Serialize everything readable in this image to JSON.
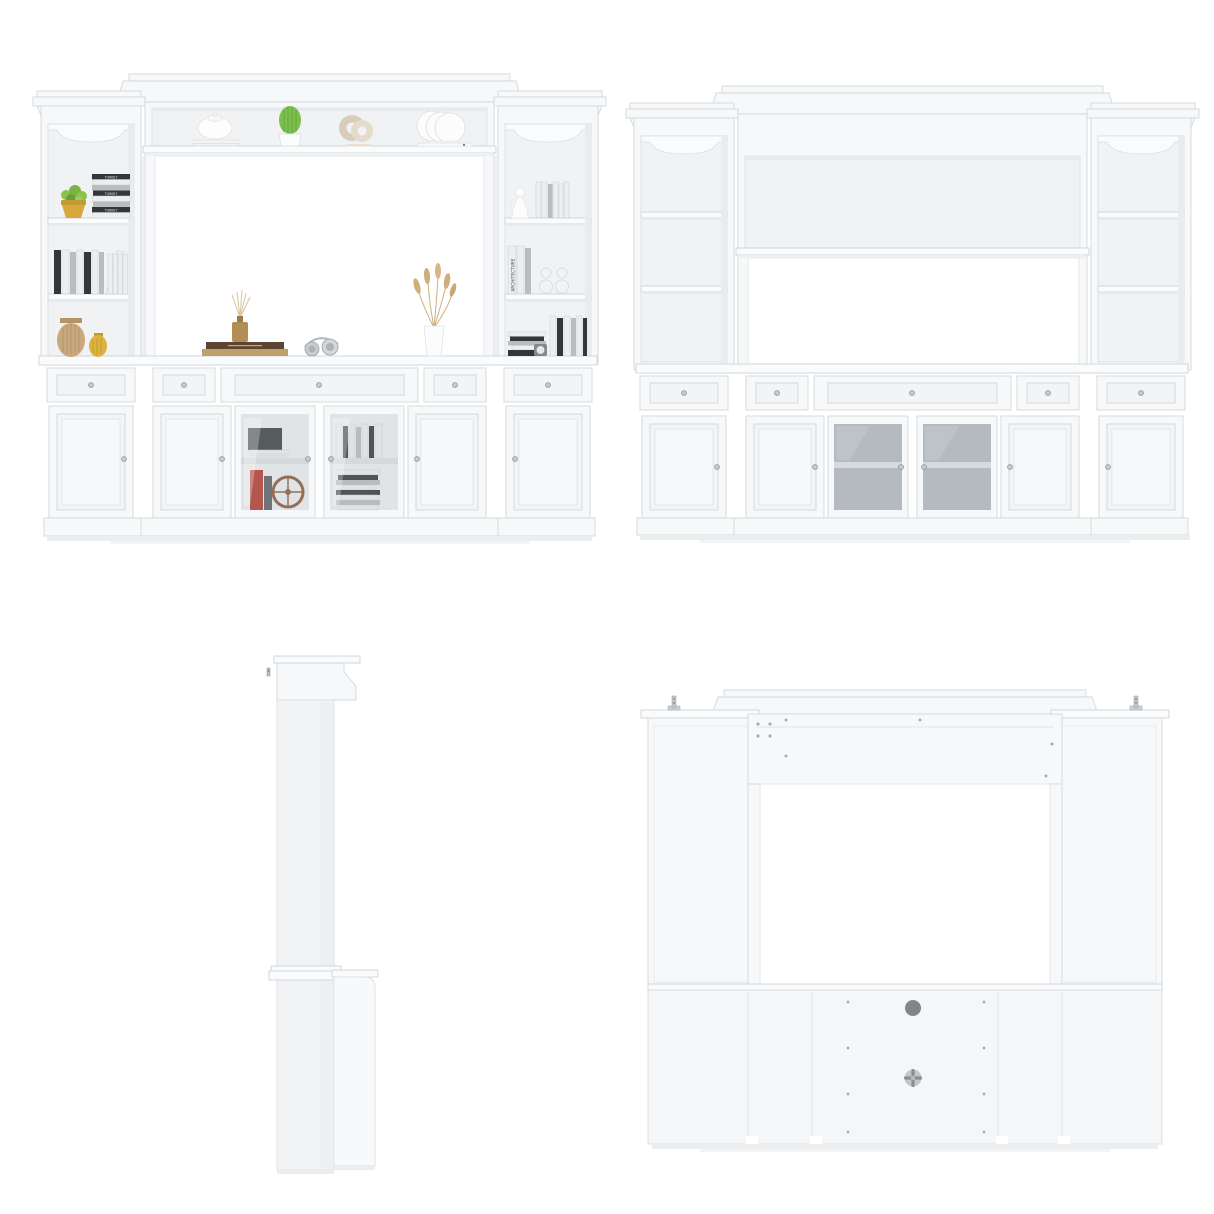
{
  "page": {
    "background": "#ffffff",
    "subject": "white-entertainment-center-wall-unit-product-collage"
  },
  "views": [
    {
      "id": "front-styled",
      "name": "front-view-with-decor"
    },
    {
      "id": "front-plain",
      "name": "front-elevation-empty"
    },
    {
      "id": "side-profile",
      "name": "side-profile-view"
    },
    {
      "id": "back",
      "name": "back-view-with-cable-holes"
    }
  ],
  "texts": {
    "turkey_spine": "TURKEY",
    "architecture_spine": "ARCHITECTURE"
  },
  "palette": {
    "background": "#ffffff",
    "panel_white": "#f7f8f9",
    "panel_bright": "#fbfcfd",
    "panel_interior": "#f0f2f3",
    "panel_shade": "#e8eaec",
    "outline_gray": "#d3d7da",
    "glass_gray": "#b4bac0",
    "glass_shelf": "#d6dadd",
    "knob_silver": "#c7ccd0",
    "knob_ring": "#878e93",
    "cable_hole_gray": "#7f8589",
    "grommet_gray": "#c3c7ca",
    "grommet_cross": "#888e92",
    "bracket_metal": "#c3c8cc",
    "screw_gray": "#aeb4b8",
    "shadow_gray": "#e9ebed",
    "succulent_green": "#8bc34a",
    "cactus_green": "#7cbf4e",
    "cactus_dark": "#5ea43a",
    "gold_pot": "#d7a93c",
    "gold_vase": "#ddb23e",
    "tan_vase": "#c9a87f",
    "tan_vase_rib": "#b08e63",
    "beige_ring": "#d8cdbc",
    "beige_ring_front": "#e4dbcb",
    "brown_book": "#5d4433",
    "tan_book": "#bfa06a",
    "amber_bottle": "#b28e57",
    "reed_tan": "#d9c9a8",
    "pampas_tan": "#cfae7e",
    "red_book": "#b43a2e",
    "dark_item": "#3c4043",
    "wheel_brown": "#8a5a3b",
    "book_dark": "#34373a",
    "book_white": "#eceeef",
    "book_gray": "#b9bdc0"
  },
  "decor_items": [
    {
      "name": "succulent-in-gold-pot",
      "color": "gold_pot"
    },
    {
      "name": "turkey-book-stack",
      "label": "TURKEY"
    },
    {
      "name": "standing-books",
      "color": "book_white"
    },
    {
      "name": "tan-ribbed-vases",
      "color": "tan_vase"
    },
    {
      "name": "white-teapot-on-books",
      "color": "panel_bright"
    },
    {
      "name": "cactus-in-white-pot",
      "color": "cactus_green"
    },
    {
      "name": "ring-sculpture",
      "color": "beige_ring"
    },
    {
      "name": "plate-rack-with-book",
      "color": "panel_bright"
    },
    {
      "name": "book-stack-with-reed-diffuser",
      "color": "amber_bottle"
    },
    {
      "name": "headphones",
      "color": "knob_silver"
    },
    {
      "name": "pampas-vase",
      "color": "pampas_tan"
    },
    {
      "name": "speaker-and-red-book-and-ship-wheel",
      "color": "red_book"
    },
    {
      "name": "book-collection-behind-glass",
      "color": "book_white"
    },
    {
      "name": "angel-figurine",
      "color": "panel_bright"
    },
    {
      "name": "architecture-books",
      "label": "ARCHITECTURE"
    },
    {
      "name": "hourglass-glass-vases",
      "color": "panel_interior"
    },
    {
      "name": "books-and-clock",
      "color": "book_dark"
    }
  ]
}
